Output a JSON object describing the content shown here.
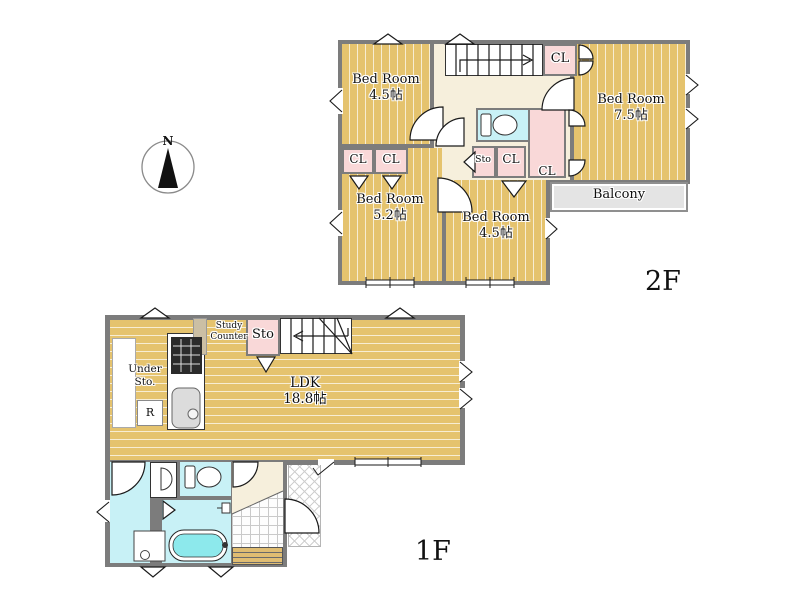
{
  "colors": {
    "wood": "#e5c36e",
    "wood_line": "#f7edd3",
    "pink": "#f9d8d8",
    "cyan": "#c8f1f6",
    "beige": "#f6efdc",
    "wall": "#7c7c7c",
    "balcony": "#e4e4e4",
    "tub_water": "#8de9ec"
  },
  "compass": {
    "label": "N"
  },
  "floor2": {
    "label": "2F",
    "bedroom_a": {
      "name": "Bed Room",
      "size": "4.5帖"
    },
    "bedroom_b": {
      "name": "Bed Room",
      "size": "7.5帖"
    },
    "bedroom_c": {
      "name": "Bed Room",
      "size": "5.2帖"
    },
    "bedroom_d": {
      "name": "Bed Room",
      "size": "4.5帖"
    },
    "balcony": "Balcony",
    "closet": "CL",
    "storage": "Sto"
  },
  "floor1": {
    "label": "1F",
    "ldk": {
      "name": "LDK",
      "size": "18.8帖"
    },
    "under_storage": {
      "line1": "Under",
      "line2": "Sto."
    },
    "study_counter": {
      "line1": "Study",
      "line2": "Counter"
    },
    "refrigerator": "R",
    "storage": "Sto"
  }
}
